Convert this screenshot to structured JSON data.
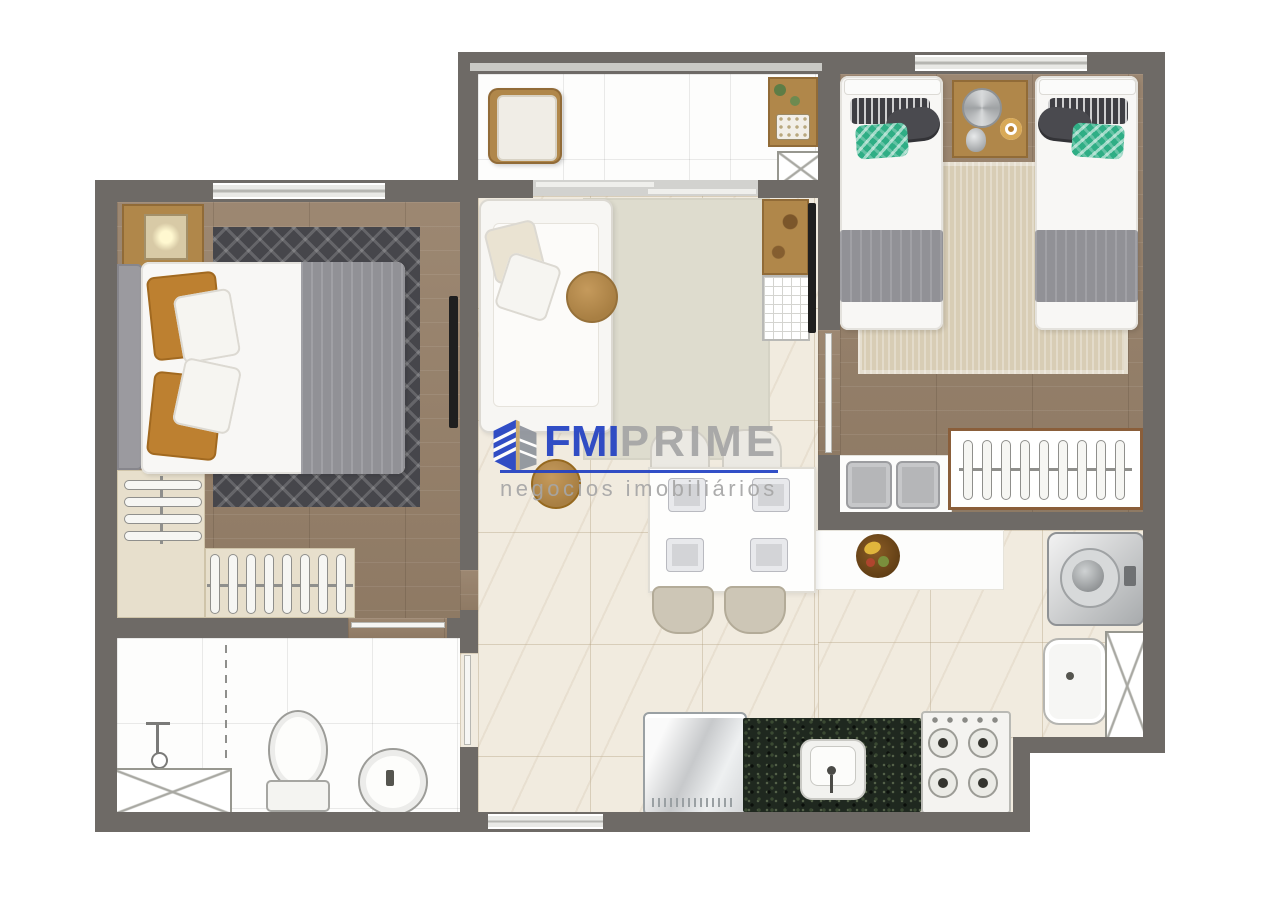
{
  "watermark": {
    "brand_primary": "FMI",
    "brand_secondary": "PRIME",
    "tagline": "negocios imobiliários"
  },
  "colors": {
    "wall": "#6e6a66",
    "wood_floor": "#97816a",
    "dark_rug": "#46464b",
    "beige_rug": "#d8cdb5",
    "living_rug": "#dedcce",
    "marble_floor": "#f1ebdf",
    "closet_beige": "#e7dfcc",
    "wood_furniture": "#b0874a",
    "granite": "#1f281f",
    "brand_blue": "#2342c3",
    "brand_gray": "#a6a6a6",
    "green_pillow": "#2fae85",
    "orange_pillow": "#bd8030"
  }
}
